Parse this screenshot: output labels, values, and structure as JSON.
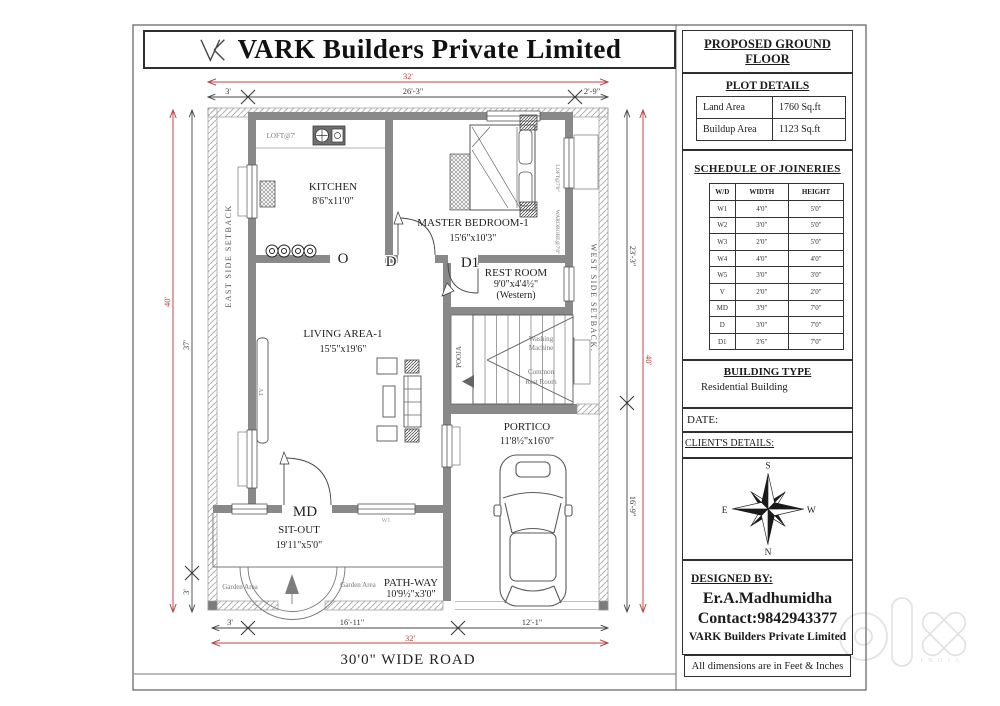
{
  "title_block": {
    "company": "VARK Builders Private Limited"
  },
  "panel": {
    "header": "PROPOSED GROUND FLOOR",
    "plot_details": {
      "title": "PLOT DETAILS",
      "rows": [
        [
          "Land Area",
          "1760 Sq.ft"
        ],
        [
          "Buildup Area",
          "1123 Sq.ft"
        ]
      ]
    },
    "joineries": {
      "title": "SCHEDULE OF JOINERIES",
      "columns": [
        "W/D",
        "WIDTH",
        "HEIGHT"
      ],
      "rows": [
        [
          "W1",
          "4'0\"",
          "5'0\""
        ],
        [
          "W2",
          "3'0\"",
          "5'0\""
        ],
        [
          "W3",
          "2'0\"",
          "5'0\""
        ],
        [
          "W4",
          "4'0\"",
          "4'0\""
        ],
        [
          "W5",
          "3'0\"",
          "3'0\""
        ],
        [
          "V",
          "2'0\"",
          "2'0\""
        ],
        [
          "MD",
          "3'9\"",
          "7'0\""
        ],
        [
          "D",
          "3'0\"",
          "7'0\""
        ],
        [
          "D1",
          "2'6\"",
          "7'0\""
        ]
      ]
    },
    "building_type": {
      "title": "BUILDING TYPE",
      "value": "Residential Building"
    },
    "date_label": "DATE:",
    "clients_label": "CLIENT'S DETAILS:",
    "compass": {
      "top": "S",
      "bottom": "N",
      "left": "E",
      "right": "W"
    },
    "designed_by": {
      "label": "DESIGNED BY:",
      "designer": "Er.A.Madhumidha",
      "contact": "Contact:9842943377",
      "company": "VARK Builders Private Limited"
    },
    "footer_note": "All dimensions are in Feet & Inches"
  },
  "plan": {
    "rooms": [
      {
        "name": "KITCHEN",
        "size": "8'6\"x11'0\""
      },
      {
        "name": "MASTER BEDROOM-1",
        "size": "15'6\"x10'3\""
      },
      {
        "name": "REST ROOM",
        "size": "9'0\"x4'4½\"",
        "note": "(Western)"
      },
      {
        "name": "LIVING AREA-1",
        "size": "15'5\"x19'6\""
      },
      {
        "name": "PORTICO",
        "size": "11'8½\"x16'0\""
      },
      {
        "name": "SIT-OUT",
        "size": "19'11\"x5'0\""
      },
      {
        "name": "PATH-WAY",
        "size": "10'9½\"x3'0\""
      }
    ],
    "doors": {
      "md": "MD",
      "d": "D",
      "d1": "D1",
      "o": "O",
      "w1": "W1"
    },
    "labels": {
      "loft": "LOFT@7'",
      "loft_wardrobe": "LOFT@7'0\"",
      "wardrobe": "WARDROBE@7'0\"",
      "pooja": "POOJA",
      "tv": "TV",
      "washing_1": "Washing",
      "washing_2": "Machine",
      "common_1": "Common",
      "common_2": "Rest Room",
      "garden": "Garden Area",
      "east_setback": "EAST SIDE SETBACK",
      "west_setback": "WEST SIDE SETBACK.",
      "road": "30'0\" WIDE ROAD"
    },
    "dimensions": {
      "top_overall": "32'",
      "top_segments": [
        "3'",
        "26'-3\"",
        "2'-9\""
      ],
      "bottom_overall": "32'",
      "bottom_segments": [
        "3'",
        "16'-11\"",
        "12'-1\""
      ],
      "left_overall": "40'",
      "left_segments": [
        "37'",
        "3'"
      ],
      "right_overall": "40'",
      "right_segments": [
        "23'-3\"",
        "16'-9\""
      ]
    },
    "colors": {
      "dimension_red": "#b8423c",
      "wall_gray": "#898989"
    }
  },
  "watermark": {
    "text": "olx",
    "sub": "I N D I A"
  }
}
